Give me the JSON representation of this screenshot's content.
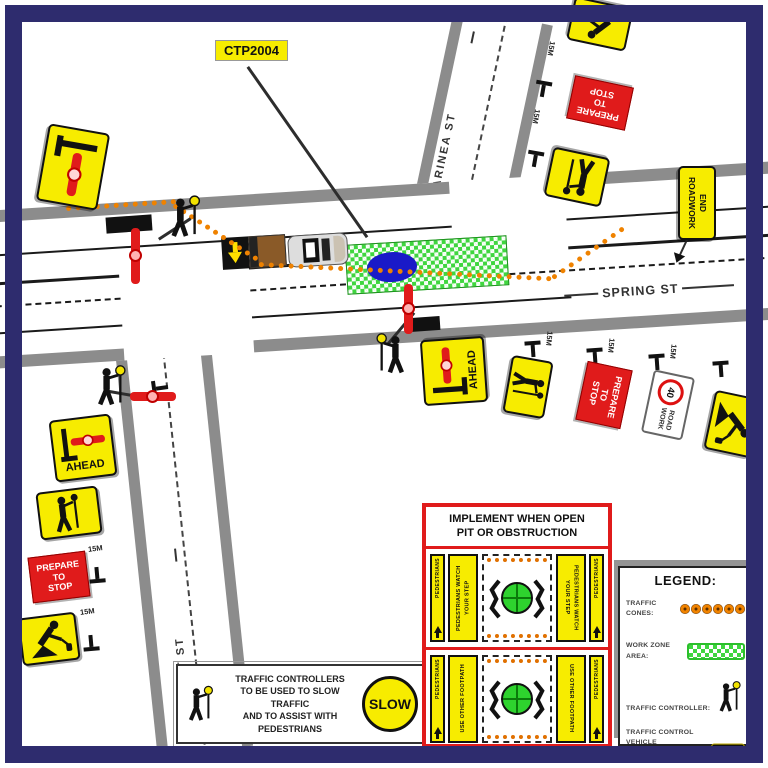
{
  "plan": {
    "ctp_label": "CTP2004"
  },
  "streets": {
    "spring": "SPRING ST",
    "marinea": "MARINEA ST",
    "short": "SHORT ST"
  },
  "signs": {
    "prepare_to_stop": {
      "l1": "PREPARE",
      "l2": "TO",
      "l3": "STOP"
    },
    "ahead": "AHEAD",
    "end_roadwork": {
      "l1": "END",
      "l2": "ROADWORK"
    },
    "speed": "40",
    "road_work": {
      "l1": "ROAD",
      "l2": "WORK"
    },
    "slow": "SLOW",
    "marker_15m": "15M"
  },
  "implement_box": {
    "title_l1": "IMPLEMENT WHEN OPEN",
    "title_l2": "PIT OR OBSTRUCTION",
    "pedestrians": "PEDESTRIANS",
    "watch_step": "PEDESTRIANS WATCH YOUR STEP",
    "use_footpath": "USE OTHER FOOTPATH"
  },
  "note": {
    "l1": "TRAFFIC CONTROLLERS",
    "l2": "TO BE USED TO SLOW TRAFFIC",
    "l3": "AND TO ASSIST WITH PEDESTRIANS"
  },
  "legend": {
    "title": "LEGEND:",
    "cones_label": "TRAFFIC CONES:",
    "workzone_label_l1": "WORK ZONE",
    "workzone_label_l2": "AREA:",
    "controller_label": "TRAFFIC CONTROLLER:",
    "vehicle_label_l1": "TRAFFIC CONTROL VEHICLE",
    "vehicle_label_l2": "w ARROW BOARD"
  },
  "colors": {
    "border_navy": "#2e2c6e",
    "cone_orange": "#ef8200",
    "work_zone_green": "#3fd63f",
    "sign_yellow": "#f7ec00",
    "sign_red": "#e01b1b",
    "pit_blue": "#1a1ac8"
  }
}
